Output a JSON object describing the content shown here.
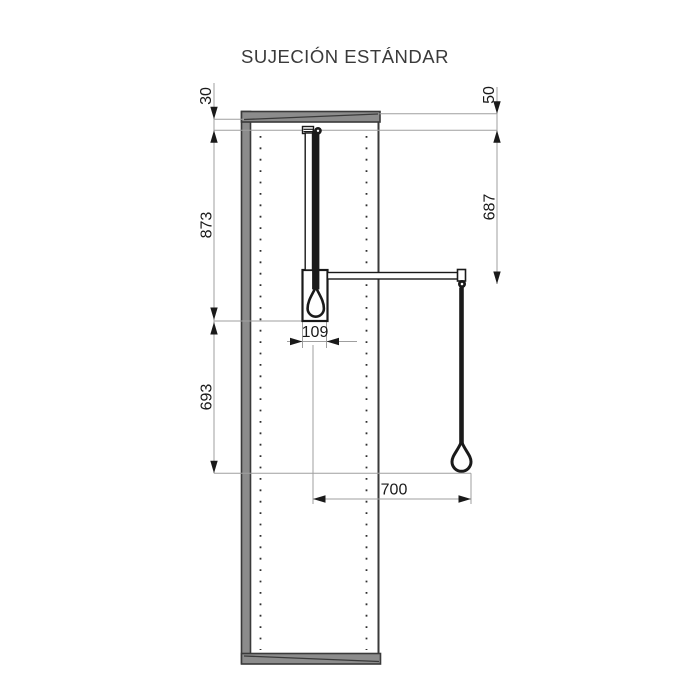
{
  "title": "SUJECIÓN ESTÁNDAR",
  "drawing": {
    "type": "technical-dimension-diagram",
    "subject": "wardrobe pull-down lift mounted on cabinet side panel"
  },
  "dims": {
    "top_inset": "30",
    "top_offset": "50",
    "upper_span": "873",
    "rod_drop": "687",
    "housing_width": "109",
    "lower_span": "693",
    "reach": "700"
  },
  "colors": {
    "background": "#ffffff",
    "ink": "#1a1a1a",
    "dim_line": "#9f9f9f",
    "panel_fill": "#8c8c8c",
    "panel_edge": "#3a3a3a",
    "hole_dots": "#2f2f2f",
    "title_color": "#3a3a3a",
    "white": "#ffffff"
  }
}
